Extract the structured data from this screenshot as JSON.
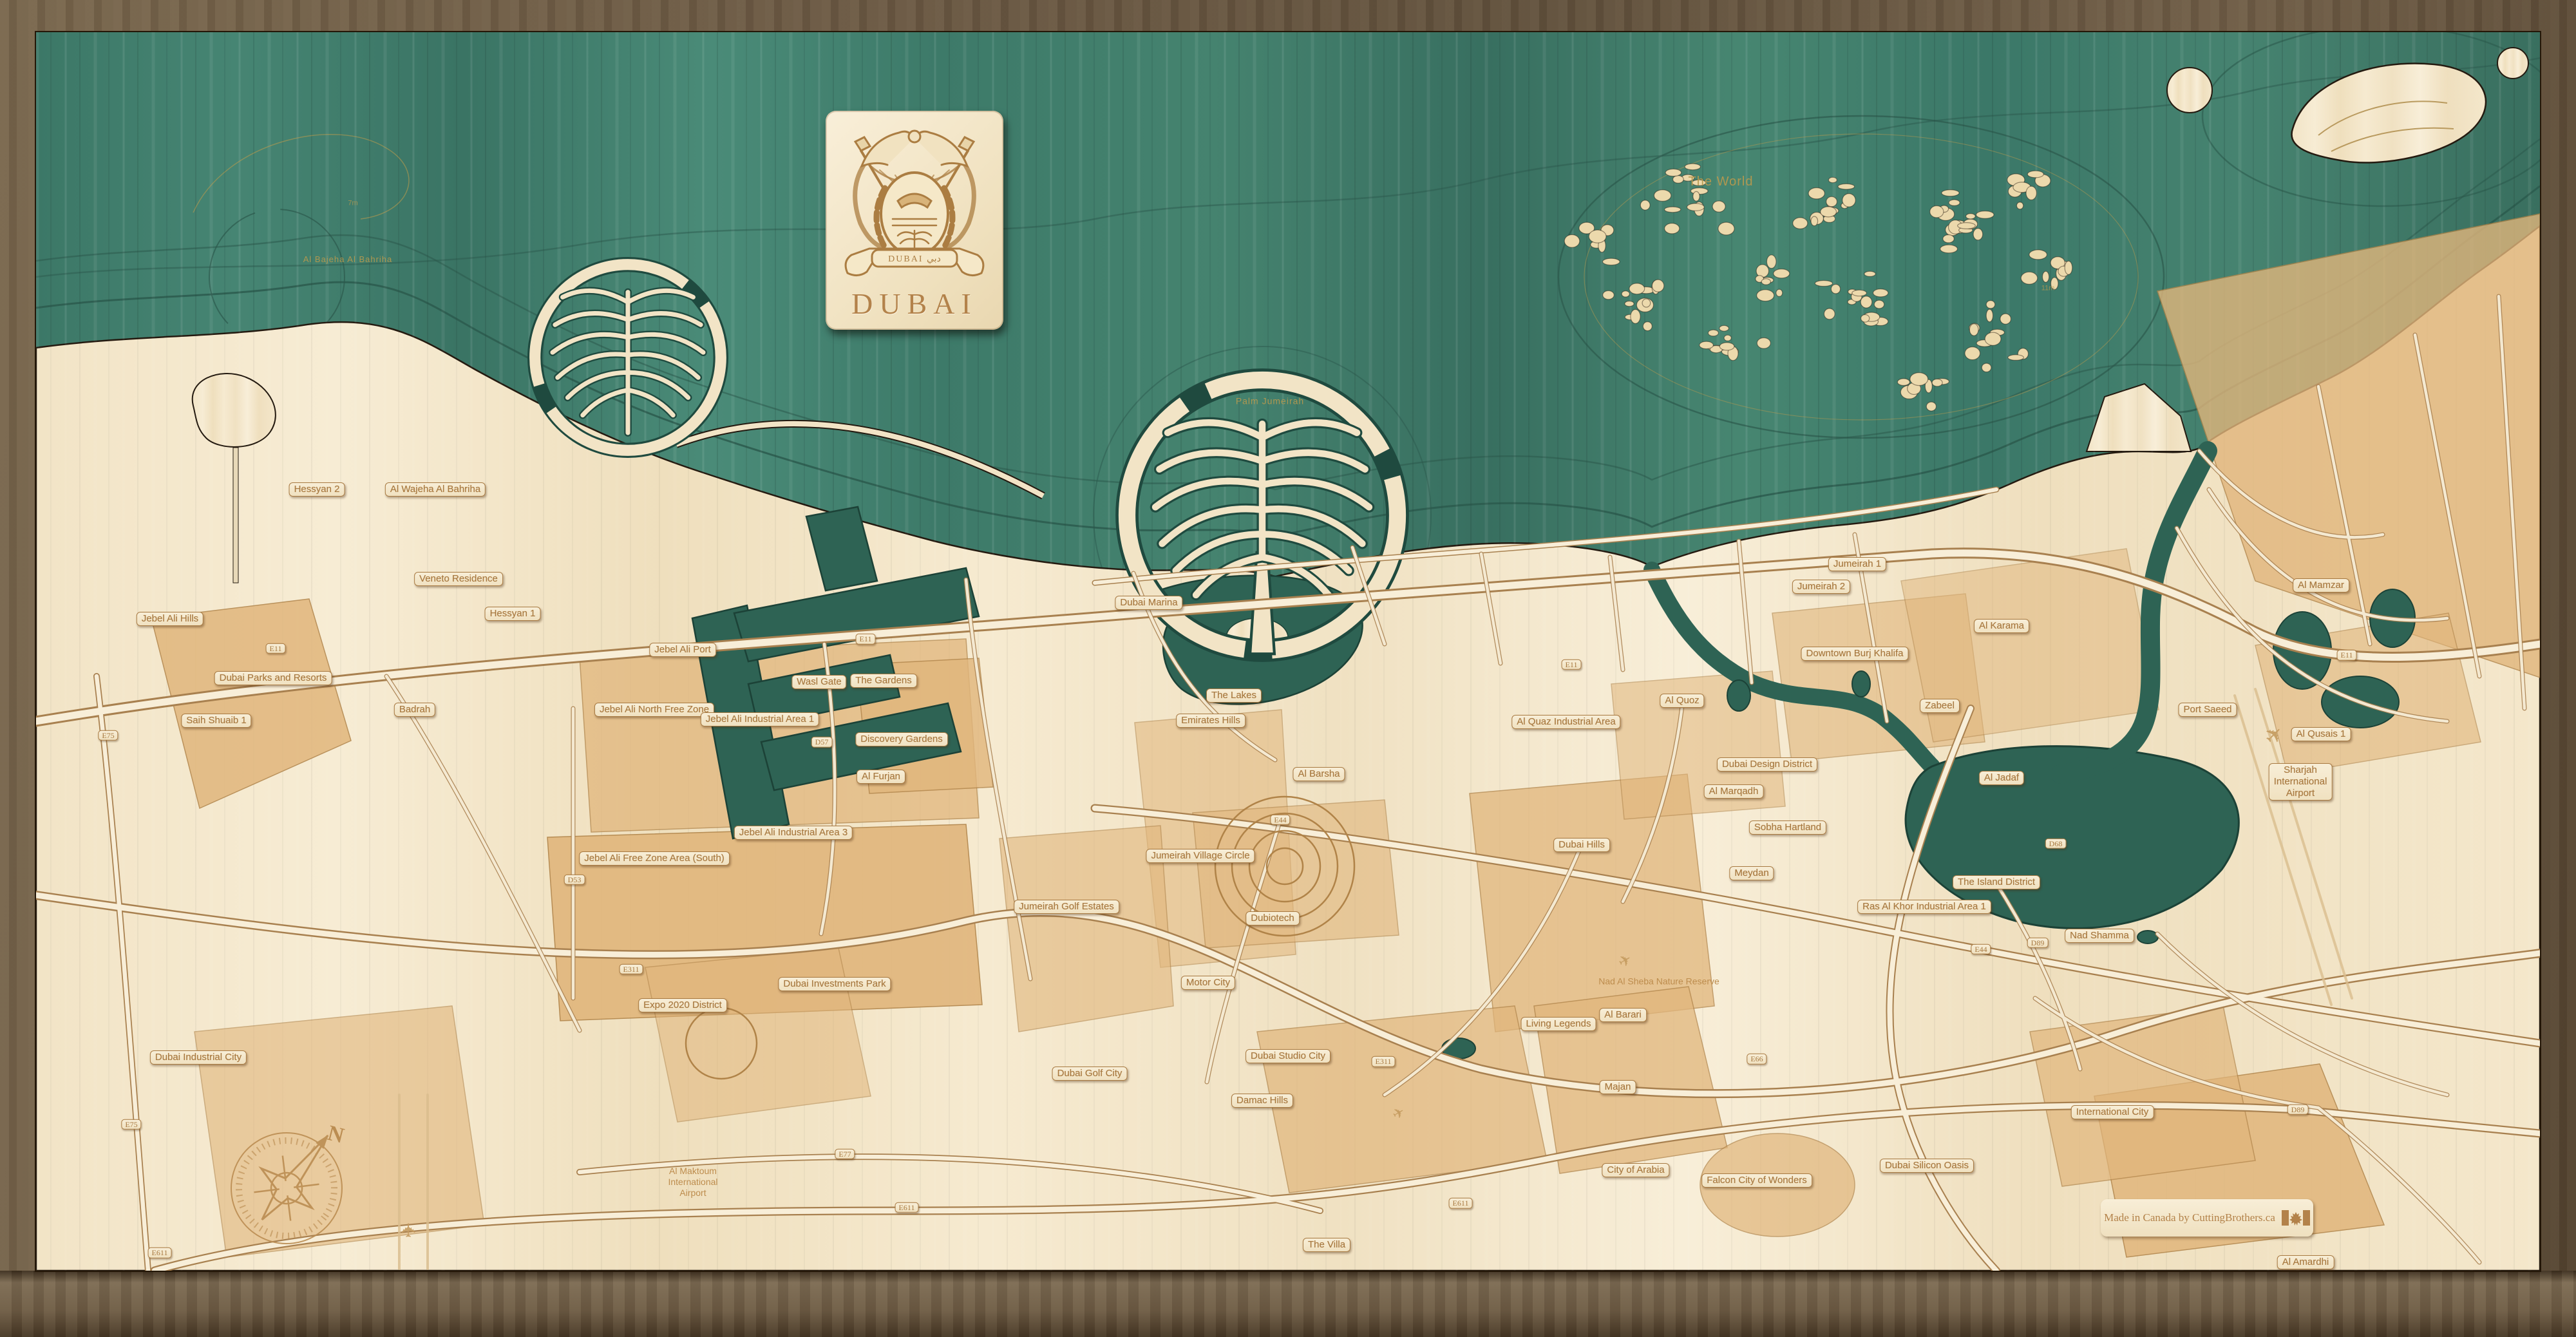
{
  "artwork": {
    "region_title": "DUBAI",
    "crest_banner": "DUBAI  دبي",
    "credit": "Made in Canada by CuttingBrothers.ca"
  },
  "colors": {
    "frame_wood": "#6a5843",
    "water_teal": "#41806f",
    "land_cream": "#f3e6cb",
    "district_tan": "#e1b67c",
    "engraving_brown": "#a87a42",
    "water_text": "#b5994f",
    "canal_teal": "#2c5f51"
  },
  "labels": {
    "items": [
      {
        "t": "Hessyan 2",
        "x": 12.3,
        "y": 36.6,
        "k": "place"
      },
      {
        "t": "Al Wajeha Al Bahriha",
        "x": 16.9,
        "y": 36.6,
        "k": "place"
      },
      {
        "t": "Veneto Residence",
        "x": 17.8,
        "y": 43.3,
        "k": "place"
      },
      {
        "t": "Hessyan 1",
        "x": 19.9,
        "y": 45.9,
        "k": "place"
      },
      {
        "t": "Jebel Ali Hills",
        "x": 6.6,
        "y": 46.3,
        "k": "place"
      },
      {
        "t": "Dubai Parks and Resorts",
        "x": 10.6,
        "y": 50.7,
        "k": "place"
      },
      {
        "t": "Saih Shuaib 1",
        "x": 8.4,
        "y": 53.9,
        "k": "place"
      },
      {
        "t": "Badrah",
        "x": 16.1,
        "y": 53.1,
        "k": "place"
      },
      {
        "t": "Jebel Ali North Free Zone",
        "x": 25.4,
        "y": 53.1,
        "k": "place"
      },
      {
        "t": "Jebel Ali Port",
        "x": 26.5,
        "y": 48.6,
        "k": "place"
      },
      {
        "t": "Jebel Ali Industrial Area 1",
        "x": 29.5,
        "y": 53.8,
        "k": "place"
      },
      {
        "t": "Wasl Gate",
        "x": 31.8,
        "y": 51.0,
        "k": "place"
      },
      {
        "t": "The Gardens",
        "x": 34.3,
        "y": 50.9,
        "k": "place"
      },
      {
        "t": "Discovery Gardens",
        "x": 35.0,
        "y": 55.3,
        "k": "place"
      },
      {
        "t": "Al Furjan",
        "x": 34.2,
        "y": 58.1,
        "k": "place"
      },
      {
        "t": "Dubai Marina",
        "x": 44.6,
        "y": 45.1,
        "k": "place"
      },
      {
        "t": "The Lakes",
        "x": 47.9,
        "y": 52.0,
        "k": "place"
      },
      {
        "t": "Emirates Hills",
        "x": 47.0,
        "y": 53.9,
        "k": "place"
      },
      {
        "t": "Al Barsha",
        "x": 51.2,
        "y": 57.9,
        "k": "place"
      },
      {
        "t": "Al Quaz Industrial Area",
        "x": 60.8,
        "y": 54.0,
        "k": "place"
      },
      {
        "t": "Al Quoz",
        "x": 65.3,
        "y": 52.4,
        "k": "place"
      },
      {
        "t": "Dubai Hills",
        "x": 61.4,
        "y": 63.2,
        "k": "place"
      },
      {
        "t": "Dubai Design District",
        "x": 68.6,
        "y": 57.2,
        "k": "place"
      },
      {
        "t": "Al Marqadh",
        "x": 67.3,
        "y": 59.2,
        "k": "place"
      },
      {
        "t": "Sobha Hartland",
        "x": 69.4,
        "y": 61.9,
        "k": "place"
      },
      {
        "t": "Meydan",
        "x": 68.0,
        "y": 65.3,
        "k": "place"
      },
      {
        "t": "Downtown Burj Khalifa",
        "x": 72.0,
        "y": 48.9,
        "k": "place"
      },
      {
        "t": "Jumeirah 1",
        "x": 72.1,
        "y": 42.2,
        "k": "place"
      },
      {
        "t": "Jumeirah 2",
        "x": 70.7,
        "y": 43.9,
        "k": "place"
      },
      {
        "t": "Al Karama",
        "x": 77.7,
        "y": 46.8,
        "k": "place"
      },
      {
        "t": "Zabeel",
        "x": 75.3,
        "y": 52.8,
        "k": "place"
      },
      {
        "t": "Port Saeed",
        "x": 85.7,
        "y": 53.1,
        "k": "place"
      },
      {
        "t": "Al Mamzar",
        "x": 90.1,
        "y": 43.8,
        "k": "place"
      },
      {
        "t": "Al Qusais 1",
        "x": 90.1,
        "y": 54.9,
        "k": "place"
      },
      {
        "t": "Sharjah\nInternational\nAirport",
        "x": 89.3,
        "y": 58.5,
        "k": "place"
      },
      {
        "t": "Al Jadaf",
        "x": 77.7,
        "y": 58.2,
        "k": "place"
      },
      {
        "t": "The Island District",
        "x": 77.5,
        "y": 66.0,
        "k": "place"
      },
      {
        "t": "Ras Al Khor Industrial Area 1",
        "x": 74.7,
        "y": 67.8,
        "k": "place"
      },
      {
        "t": "Nad Shamma",
        "x": 81.5,
        "y": 70.0,
        "k": "place"
      },
      {
        "t": "Jumeirah Village Circle",
        "x": 46.6,
        "y": 64.0,
        "k": "place"
      },
      {
        "t": "Jumeirah Golf Estates",
        "x": 41.4,
        "y": 67.8,
        "k": "place"
      },
      {
        "t": "Dubiotech",
        "x": 49.4,
        "y": 68.7,
        "k": "place"
      },
      {
        "t": "Motor City",
        "x": 46.9,
        "y": 73.5,
        "k": "place"
      },
      {
        "t": "Jebel Ali Industrial Area 3",
        "x": 30.8,
        "y": 62.3,
        "k": "place"
      },
      {
        "t": "Jebel Ali Free Zone Area (South)",
        "x": 25.4,
        "y": 64.2,
        "k": "place"
      },
      {
        "t": "Expo 2020 District",
        "x": 26.5,
        "y": 75.2,
        "k": "place"
      },
      {
        "t": "Dubai Investments Park",
        "x": 32.4,
        "y": 73.6,
        "k": "place"
      },
      {
        "t": "Dubai Industrial City",
        "x": 7.7,
        "y": 79.1,
        "k": "place"
      },
      {
        "t": "Dubai Golf City",
        "x": 42.3,
        "y": 80.3,
        "k": "place"
      },
      {
        "t": "Dubai Studio City",
        "x": 50.0,
        "y": 79.0,
        "k": "place"
      },
      {
        "t": "Damac Hills",
        "x": 49.0,
        "y": 82.3,
        "k": "place"
      },
      {
        "t": "Living Legends",
        "x": 60.5,
        "y": 76.6,
        "k": "place"
      },
      {
        "t": "Al Barari",
        "x": 63.0,
        "y": 75.9,
        "k": "place"
      },
      {
        "t": "Majan",
        "x": 62.8,
        "y": 81.3,
        "k": "place"
      },
      {
        "t": "City of Arabia",
        "x": 63.5,
        "y": 87.5,
        "k": "place"
      },
      {
        "t": "Falcon City of Wonders",
        "x": 68.2,
        "y": 88.3,
        "k": "place"
      },
      {
        "t": "Dubai Silicon Oasis",
        "x": 74.8,
        "y": 87.2,
        "k": "place"
      },
      {
        "t": "International City",
        "x": 82.0,
        "y": 83.2,
        "k": "place"
      },
      {
        "t": "The Villa",
        "x": 51.5,
        "y": 93.1,
        "k": "place"
      },
      {
        "t": "Al Amardhi",
        "x": 89.5,
        "y": 94.4,
        "k": "place"
      },
      {
        "t": "E11",
        "x": 10.7,
        "y": 48.5,
        "k": "road"
      },
      {
        "t": "E11",
        "x": 33.6,
        "y": 47.8,
        "k": "road"
      },
      {
        "t": "E11",
        "x": 61.0,
        "y": 49.7,
        "k": "road"
      },
      {
        "t": "E11",
        "x": 91.1,
        "y": 49.0,
        "k": "road"
      },
      {
        "t": "E75",
        "x": 4.2,
        "y": 55.0,
        "k": "road"
      },
      {
        "t": "E75",
        "x": 5.1,
        "y": 84.1,
        "k": "road"
      },
      {
        "t": "E611",
        "x": 6.2,
        "y": 93.7,
        "k": "road"
      },
      {
        "t": "E611",
        "x": 35.2,
        "y": 90.3,
        "k": "road"
      },
      {
        "t": "E611",
        "x": 56.7,
        "y": 90.0,
        "k": "road"
      },
      {
        "t": "E311",
        "x": 24.5,
        "y": 72.5,
        "k": "road"
      },
      {
        "t": "E311",
        "x": 53.7,
        "y": 79.4,
        "k": "road"
      },
      {
        "t": "E44",
        "x": 49.7,
        "y": 61.3,
        "k": "road"
      },
      {
        "t": "E44",
        "x": 76.9,
        "y": 71.0,
        "k": "road"
      },
      {
        "t": "E77",
        "x": 32.8,
        "y": 86.3,
        "k": "road"
      },
      {
        "t": "E66",
        "x": 68.2,
        "y": 79.2,
        "k": "road"
      },
      {
        "t": "D57",
        "x": 31.9,
        "y": 55.5,
        "k": "road"
      },
      {
        "t": "D53",
        "x": 22.3,
        "y": 65.8,
        "k": "road"
      },
      {
        "t": "D68",
        "x": 79.8,
        "y": 63.1,
        "k": "road"
      },
      {
        "t": "D89",
        "x": 79.1,
        "y": 70.5,
        "k": "road"
      },
      {
        "t": "D89",
        "x": 89.2,
        "y": 83.0,
        "k": "road"
      },
      {
        "t": "The World",
        "x": 66.8,
        "y": 13.6,
        "k": "water",
        "s": 20
      },
      {
        "t": "Palm Jumeirah",
        "x": 49.3,
        "y": 30.0,
        "k": "water",
        "s": 14
      },
      {
        "t": "Al Bajeha Al Bahriha",
        "x": 13.5,
        "y": 19.4,
        "k": "water",
        "s": 13
      },
      {
        "t": "7m",
        "x": 13.7,
        "y": 15.2,
        "k": "depth"
      },
      {
        "t": "11m",
        "x": 79.5,
        "y": 21.6,
        "k": "depth"
      },
      {
        "t": "Nad Al Sheba Nature Reserve",
        "x": 64.4,
        "y": 73.4,
        "k": "plain it",
        "s": 14
      },
      {
        "t": "Al Maktoum\nInternational\nAirport",
        "x": 26.9,
        "y": 88.4,
        "k": "plain",
        "s": 14
      },
      {
        "t": "✈",
        "x": 88.3,
        "y": 55.0,
        "k": "plane",
        "s": 34,
        "r": -45
      },
      {
        "t": "✈",
        "x": 15.9,
        "y": 92.0,
        "k": "plane",
        "s": 30,
        "r": -90
      },
      {
        "t": "✈",
        "x": 63.1,
        "y": 71.9,
        "k": "plane",
        "s": 24,
        "r": -30
      },
      {
        "t": "✈",
        "x": 54.3,
        "y": 83.3,
        "k": "plane",
        "s": 22,
        "r": -30
      }
    ]
  }
}
